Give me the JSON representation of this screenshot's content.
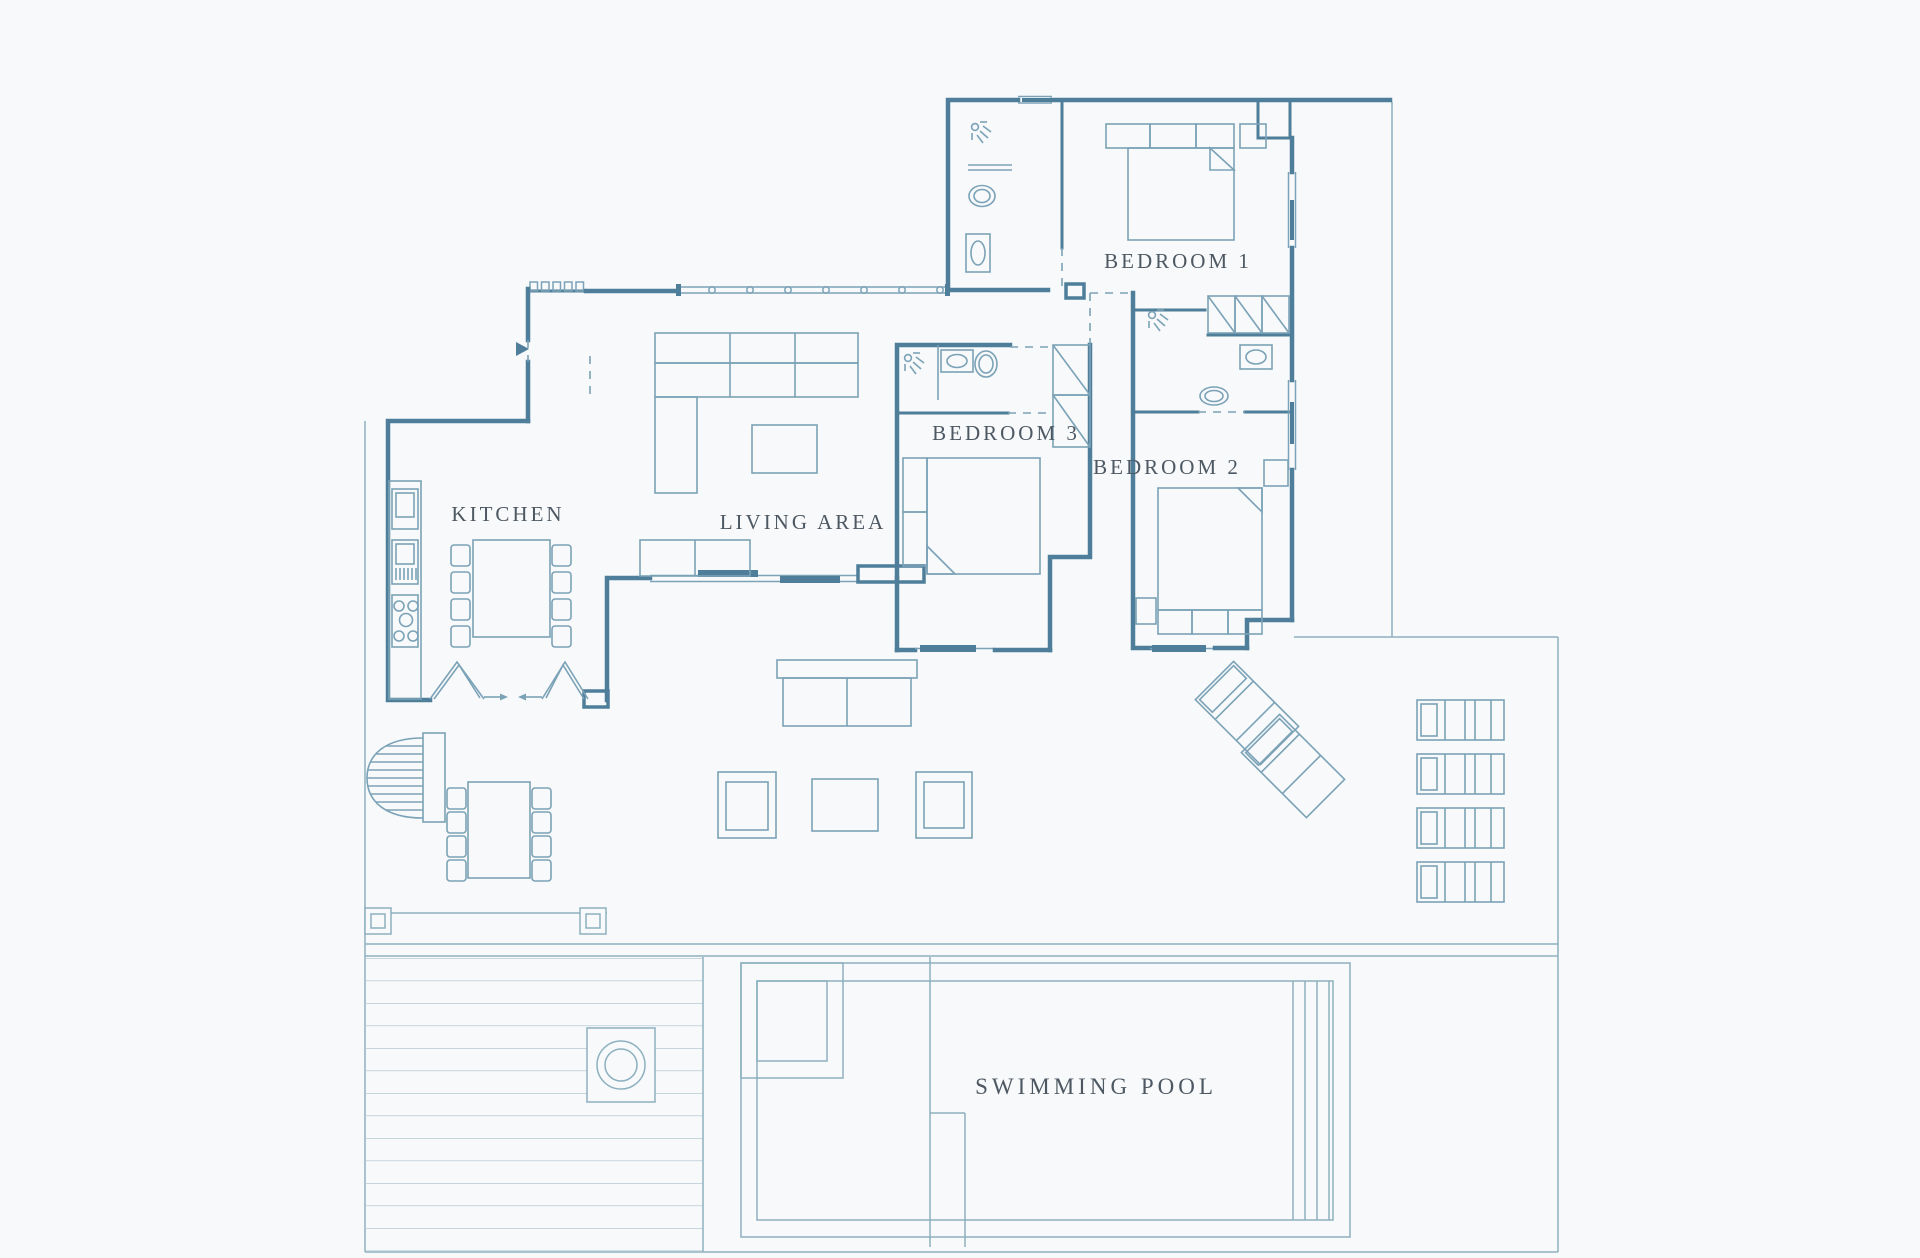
{
  "theme": {
    "bg": "#f7f9fa",
    "wall": "#4e7e99",
    "furn": "#7ba2b7",
    "bound": "#8db0c0",
    "deck": "#aac1cd",
    "label": "#4d5863"
  },
  "rooms": [
    {
      "id": "kitchen",
      "label": "KITCHEN"
    },
    {
      "id": "living-area",
      "label": "LIVING AREA"
    },
    {
      "id": "bedroom-1",
      "label": "BEDROOM 1"
    },
    {
      "id": "bedroom-2",
      "label": "BEDROOM 2"
    },
    {
      "id": "bedroom-3",
      "label": "BEDROOM 3"
    },
    {
      "id": "swimming-pool",
      "label": "SWIMMING POOL"
    }
  ]
}
